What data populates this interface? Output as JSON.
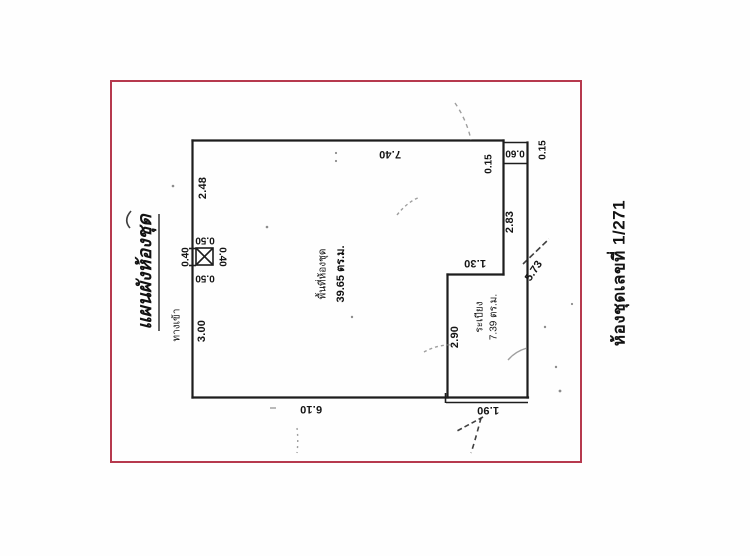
{
  "document": {
    "type_note": "scanned condominium unit floor plan",
    "left_title": "แผนผังห้องชุด",
    "right_title": "ห้องชุดเลขที่ 1/271"
  },
  "colors": {
    "frame_red": "#b6394e",
    "ink": "#1d1d1d"
  },
  "unit": {
    "area_label": "พื้นที่ห้องชุด",
    "area_value": "39.65 ตร.ม.",
    "entrance_label": "ทางเข้า"
  },
  "balcony": {
    "name": "ระเบียง",
    "area_value": "7.39 ตร.ม."
  },
  "dims": {
    "top": "7.40",
    "left_upper": "2.48",
    "shaft_above": "0.50",
    "shaft_left": "0.40",
    "shaft_right": "0.40",
    "shaft_below": "0.50",
    "left_lower": "3.00",
    "bottom_main": "6.10",
    "bottom_balcony": "1.90",
    "balcony_left": "2.90",
    "balcony_top": "1.30",
    "right_inner": "2.83",
    "right_outer": "5.73",
    "corner_wall_left": "0.15",
    "corner_column": "0.60",
    "corner_wall_right": "0.15"
  }
}
